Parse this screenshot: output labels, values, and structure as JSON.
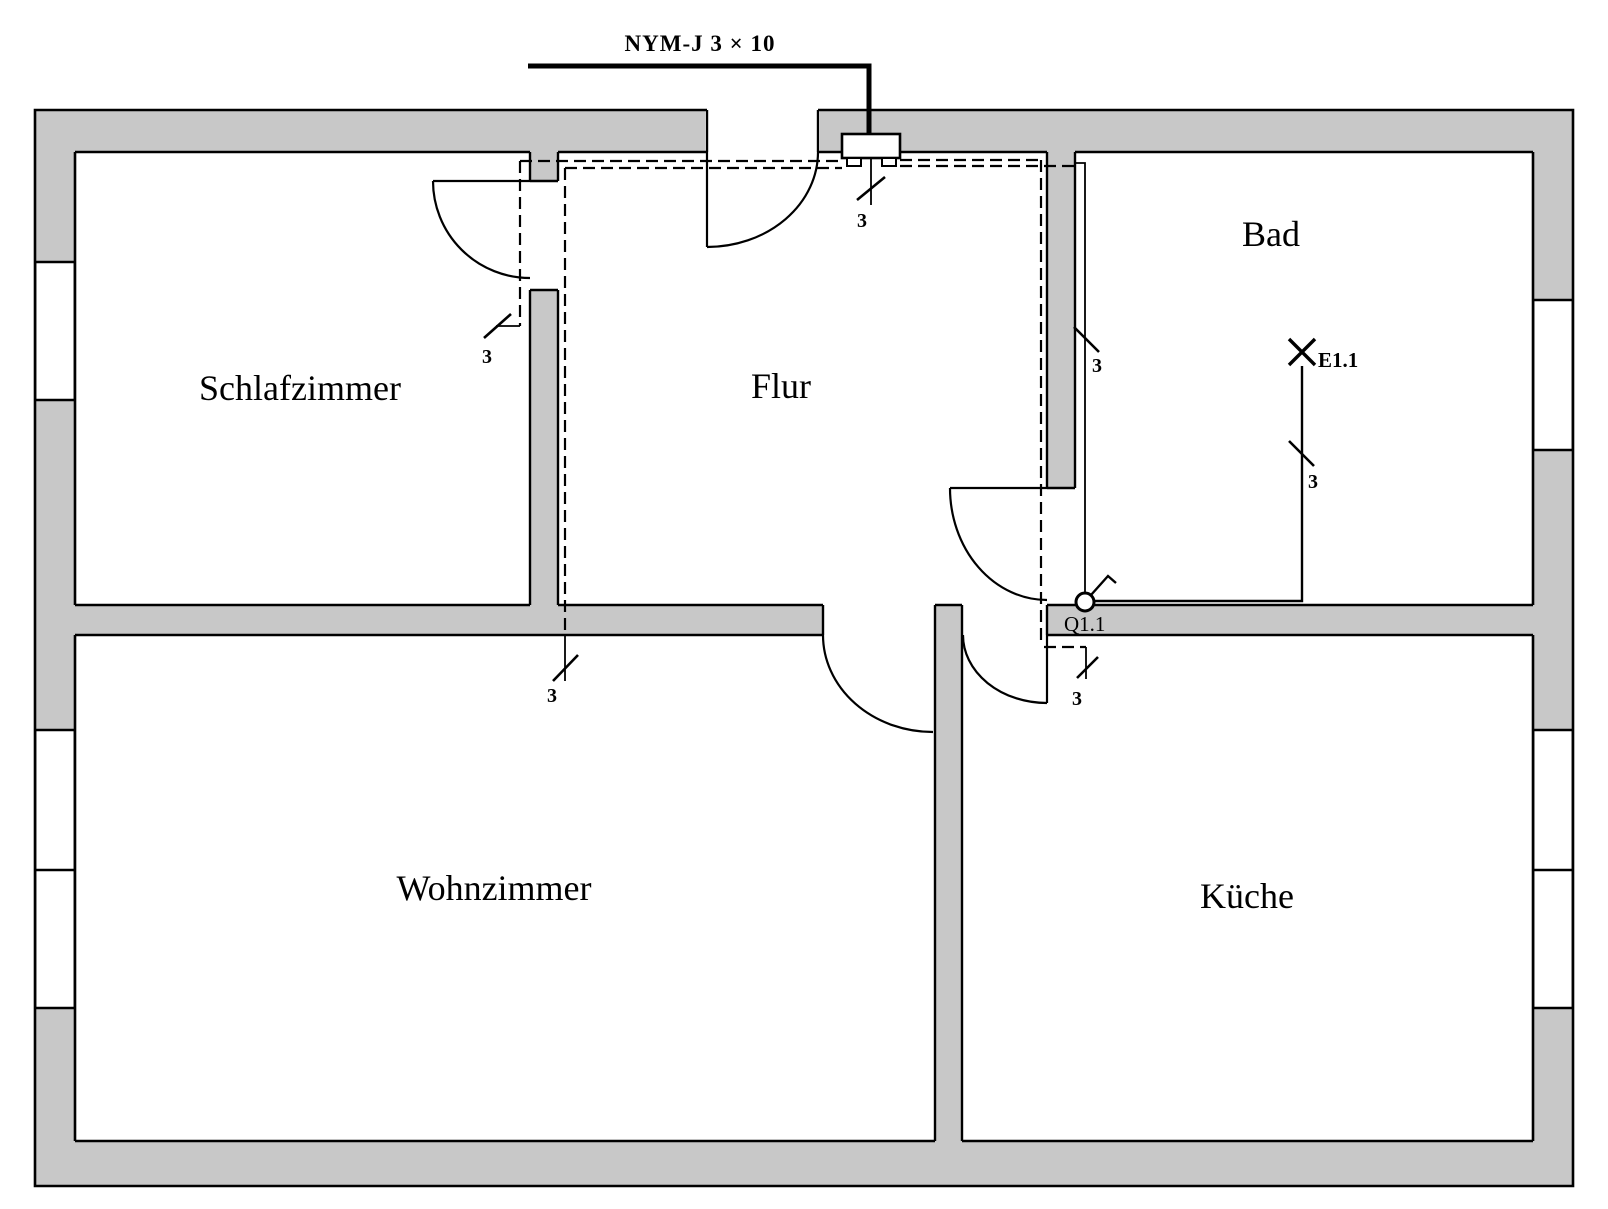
{
  "diagram": {
    "kind": "electrical-installation-floor-plan",
    "cable_label": "NYM-J 3 × 10",
    "conductor_count_label": "3",
    "device_labels": {
      "lamp": "E1.1",
      "switch": "Q1.1"
    }
  },
  "rooms": {
    "schlafzimmer": "Schlafzimmer",
    "flur": "Flur",
    "bad": "Bad",
    "wohnzimmer": "Wohnzimmer",
    "kueche": "Küche"
  },
  "labels": {
    "cable": "NYM-J 3 × 10",
    "conductors": "3",
    "lamp": "E1.1",
    "switch": "Q1.1"
  },
  "symbols": {
    "junction_box": "junction-box",
    "lamp": "lamp-cross-symbol",
    "switch": "switch-circle-symbol",
    "conductor_mark": "three-conductor-slash"
  },
  "colors": {
    "wall_fill": "#c8c8c8",
    "line": "#000000",
    "background": "#ffffff"
  }
}
